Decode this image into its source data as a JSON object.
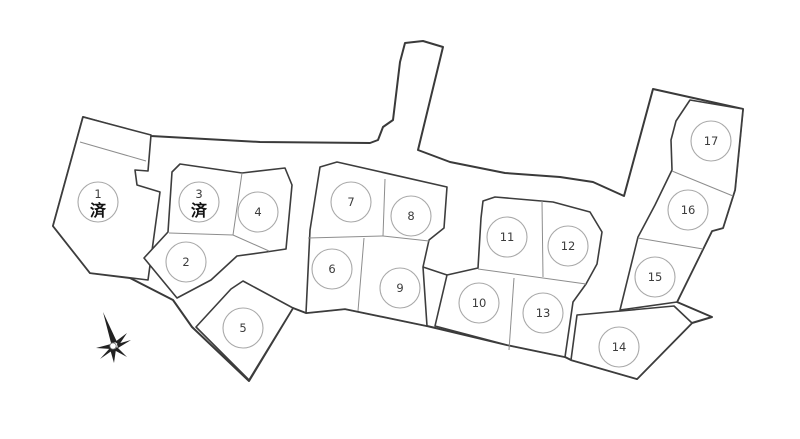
{
  "page": {
    "background": "#ffffff"
  },
  "legend": {
    "sold_label": "済"
  },
  "lots": [
    {
      "id": "1",
      "label": "1",
      "sold": true,
      "cx": 98,
      "cy": 202
    },
    {
      "id": "2",
      "label": "2",
      "sold": false,
      "cx": 186,
      "cy": 262
    },
    {
      "id": "3",
      "label": "3",
      "sold": true,
      "cx": 199,
      "cy": 202
    },
    {
      "id": "4",
      "label": "4",
      "sold": false,
      "cx": 258,
      "cy": 212
    },
    {
      "id": "5",
      "label": "5",
      "sold": false,
      "cx": 243,
      "cy": 328
    },
    {
      "id": "6",
      "label": "6",
      "sold": false,
      "cx": 332,
      "cy": 269
    },
    {
      "id": "7",
      "label": "7",
      "sold": false,
      "cx": 351,
      "cy": 202
    },
    {
      "id": "8",
      "label": "8",
      "sold": false,
      "cx": 411,
      "cy": 216
    },
    {
      "id": "9",
      "label": "9",
      "sold": false,
      "cx": 400,
      "cy": 288
    },
    {
      "id": "10",
      "label": "10",
      "sold": false,
      "cx": 479,
      "cy": 303
    },
    {
      "id": "11",
      "label": "11",
      "sold": false,
      "cx": 507,
      "cy": 237
    },
    {
      "id": "12",
      "label": "12",
      "sold": false,
      "cx": 568,
      "cy": 246
    },
    {
      "id": "13",
      "label": "13",
      "sold": false,
      "cx": 543,
      "cy": 313
    },
    {
      "id": "14",
      "label": "14",
      "sold": false,
      "cx": 619,
      "cy": 347
    },
    {
      "id": "15",
      "label": "15",
      "sold": false,
      "cx": 655,
      "cy": 277
    },
    {
      "id": "16",
      "label": "16",
      "sold": false,
      "cx": 688,
      "cy": 210
    },
    {
      "id": "17",
      "label": "17",
      "sold": false,
      "cx": 711,
      "cy": 141
    }
  ],
  "compass": {
    "name": "north-indicator"
  },
  "colors": {
    "outline": "#3a3a3a",
    "block": "#3d3d3d",
    "divider": "#8d8d8d",
    "circle": "#a9a9a9",
    "number": "#3c3c3c",
    "sold": "#111111"
  }
}
